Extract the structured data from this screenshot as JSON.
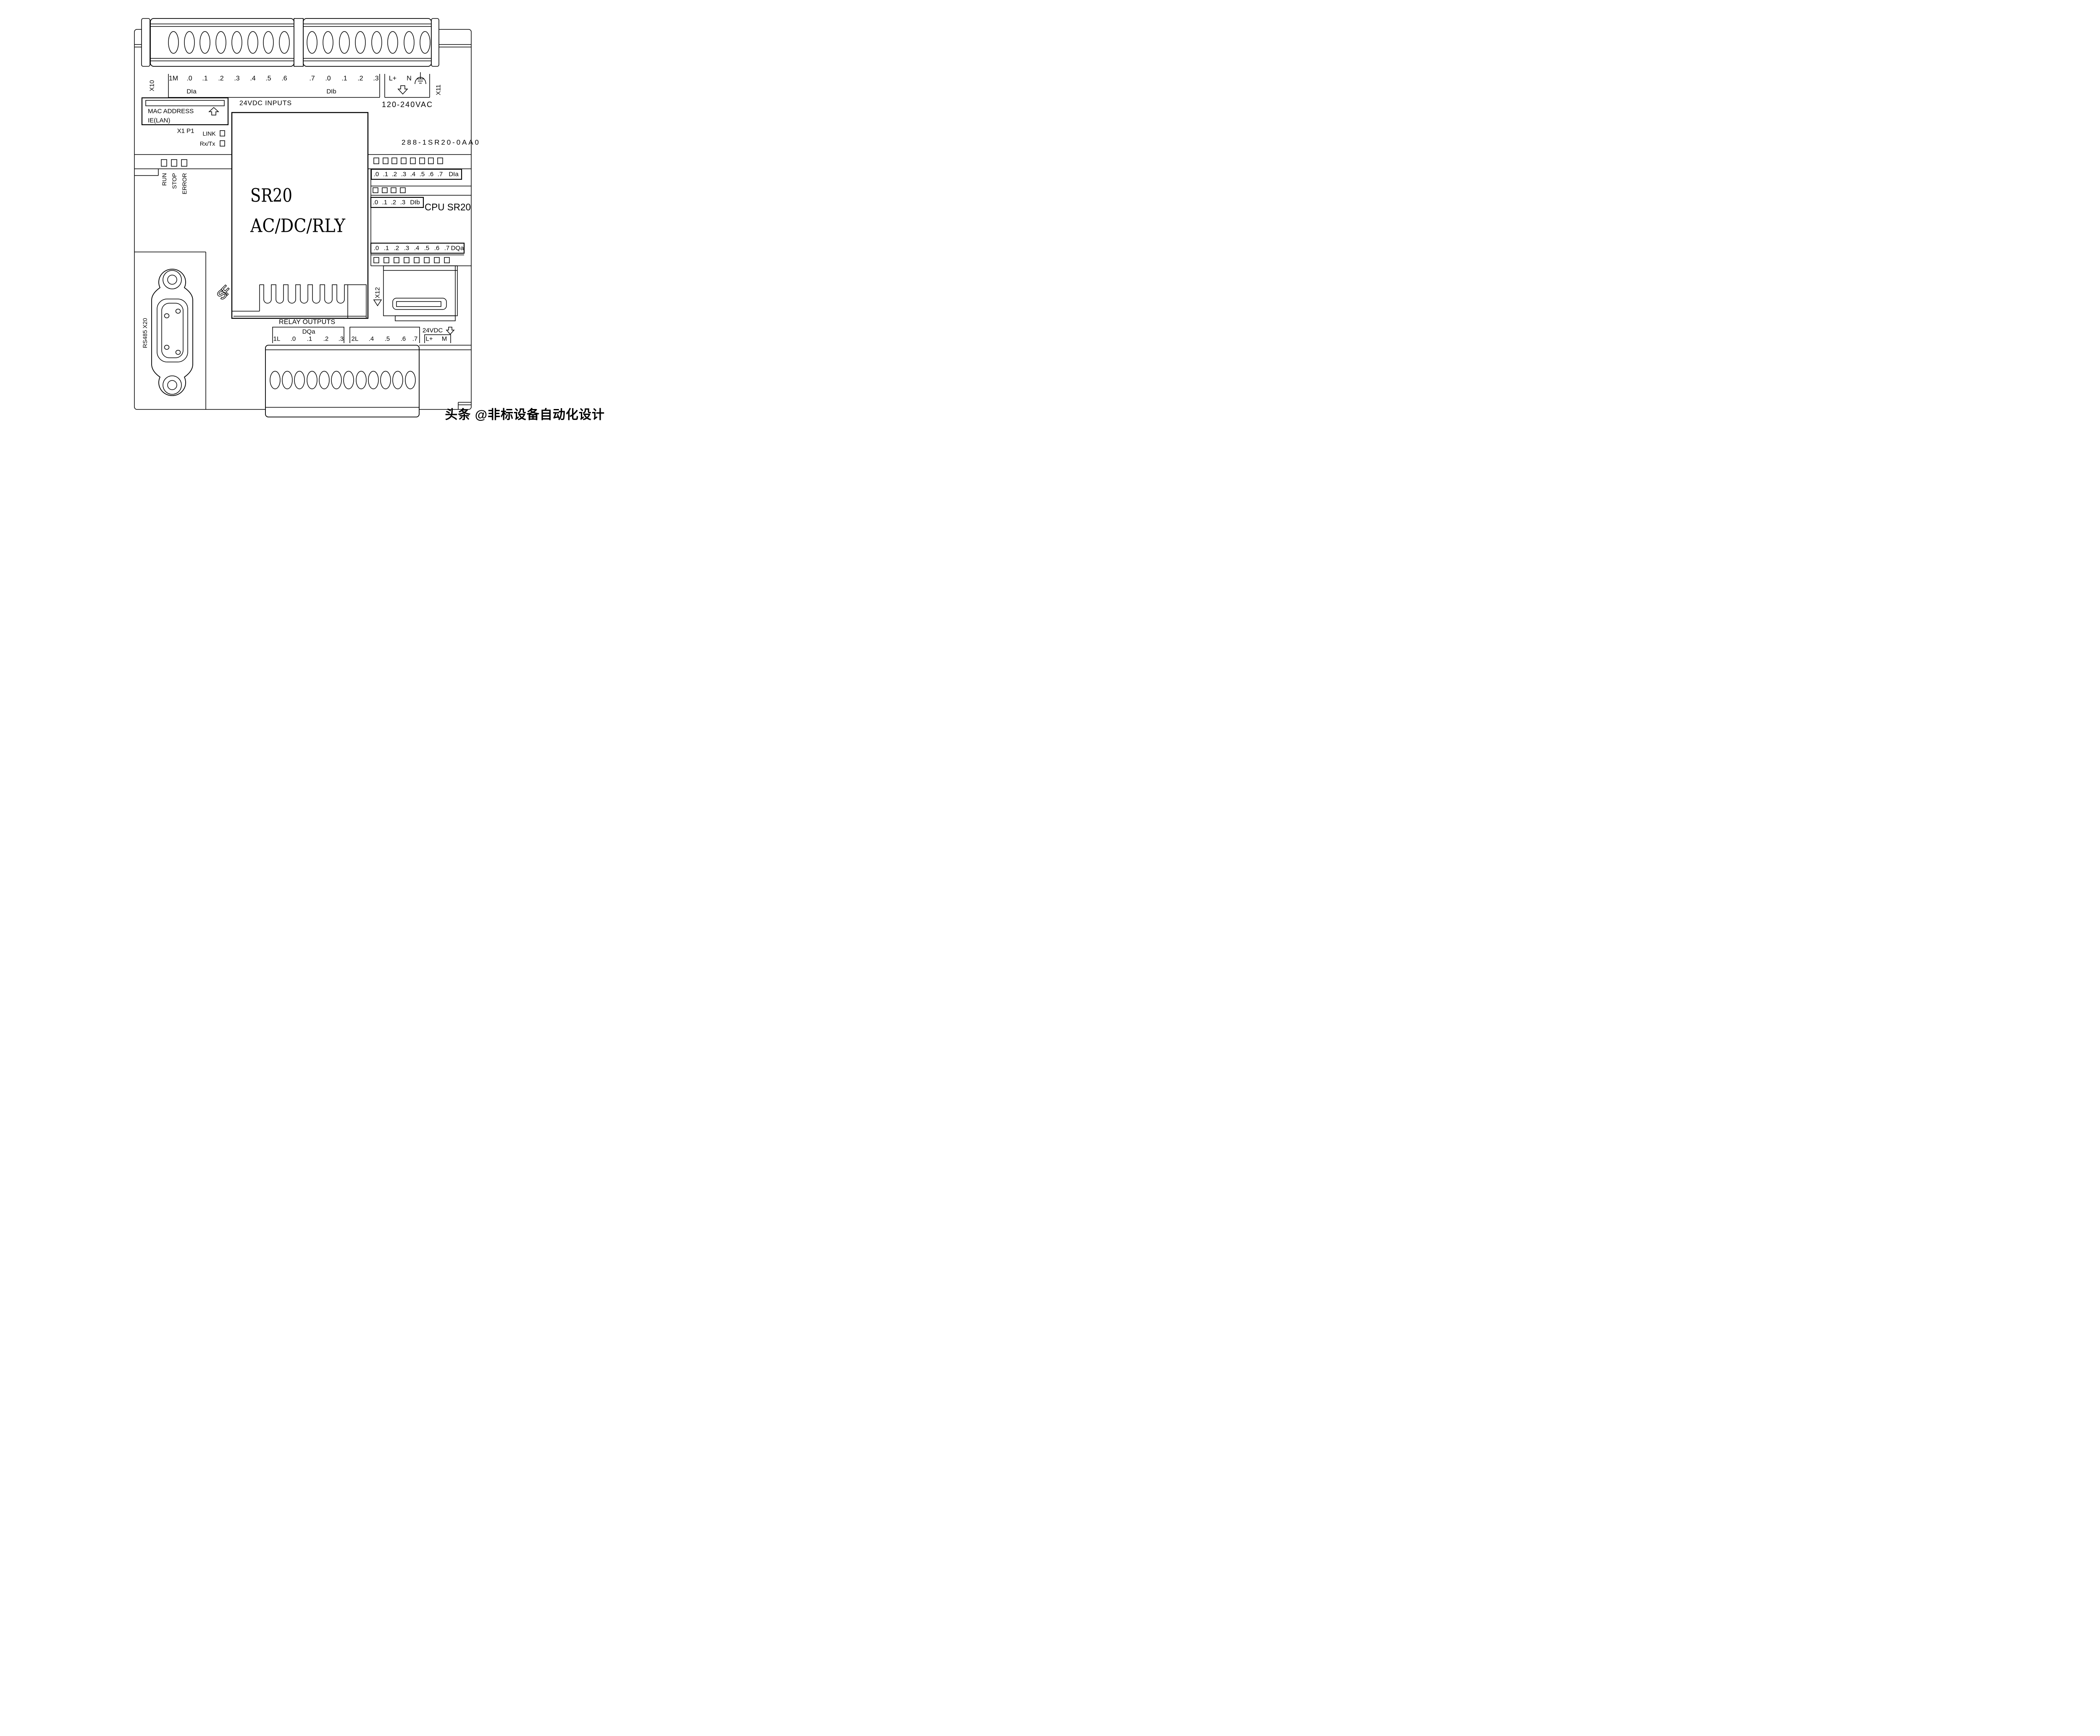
{
  "case": {
    "order_number": "288-1SR20-0AA0",
    "cpu_name": "CPU SR20",
    "face_line1": "SR20",
    "face_line2": "AC/DC/RLY"
  },
  "top_connector": {
    "x10": "X10",
    "x11": "X11",
    "inputs_caption": "24VDC INPUTS",
    "dia": {
      "label": "DIa",
      "terminals": [
        "1M",
        ".0",
        ".1",
        ".2",
        ".3",
        ".4",
        ".5",
        ".6"
      ]
    },
    "dib": {
      "label": "DIb",
      "terminals": [
        ".7",
        ".0",
        ".1",
        ".2",
        ".3"
      ]
    },
    "power": {
      "l": "L+",
      "n": "N",
      "caption": "120-240VAC",
      "ground_icon": "earth-ground-icon",
      "arrow_icon": "power-in-arrow-icon"
    }
  },
  "ethernet": {
    "line1": "MAC ADDRESS",
    "line2": "IE(LAN)",
    "port": "X1 P1",
    "led1": "LINK",
    "led2": "Rx/Tx"
  },
  "status_leds": {
    "run": "RUN",
    "stop": "STOP",
    "error": "ERROR"
  },
  "led_rows": {
    "dia": {
      "digits": [
        ".0",
        ".1",
        ".2",
        ".3",
        ".4",
        ".5",
        ".6",
        ".7"
      ],
      "label": "DIa"
    },
    "dib": {
      "digits": [
        ".0",
        ".1",
        ".2",
        ".3"
      ],
      "label": "DIb"
    },
    "dqa": {
      "digits": [
        ".0",
        ".1",
        ".2",
        ".3",
        ".4",
        ".5",
        ".6",
        ".7"
      ],
      "label": "DQa"
    }
  },
  "outputs": {
    "caption": "RELAY OUTPUTS",
    "group_label": "DQa",
    "bank1": [
      "1L",
      ".0",
      ".1",
      ".2",
      ".3"
    ],
    "bank2": [
      "2L",
      ".4",
      ".5",
      ".6",
      ".7"
    ],
    "sensor_supply": {
      "caption": "24VDC",
      "l": "L+",
      "m": "M",
      "arrow_icon": "power-out-arrow-icon"
    }
  },
  "rs485": {
    "label": "RS485 X20"
  },
  "card": {
    "label": "X12"
  },
  "watermark": "头条 @非标设备自动化设计"
}
